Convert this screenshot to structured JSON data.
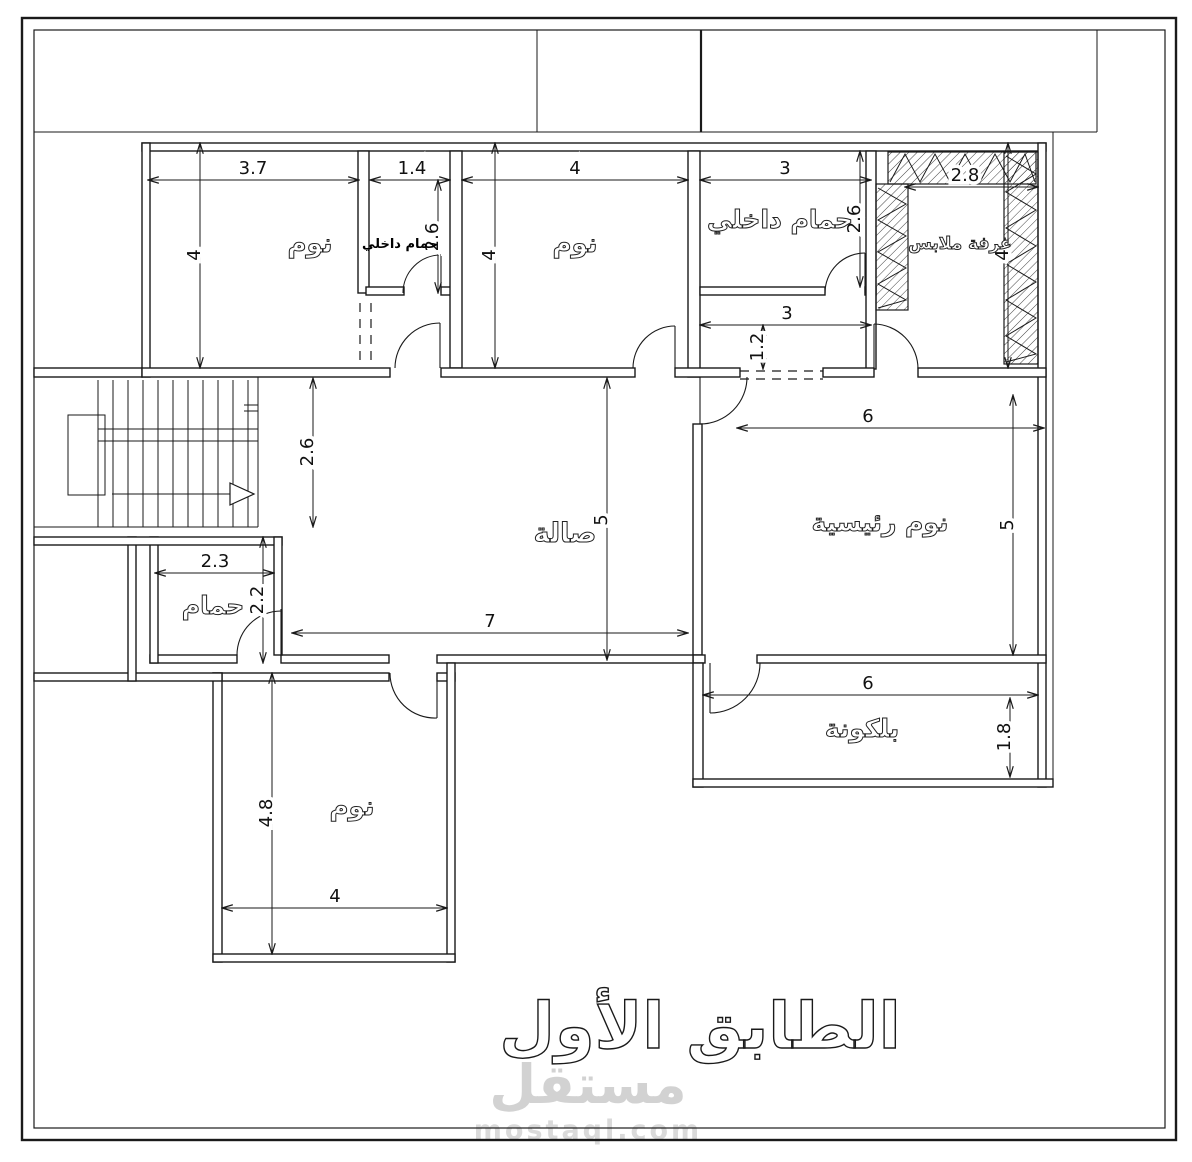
{
  "drawing": {
    "floor_title": "الطابق الأول",
    "watermark": {
      "logo": "مستقل",
      "url": "mostaql.com"
    },
    "colors": {
      "line": "#1a1a1a",
      "watermark_logo": "#d2d2d2",
      "watermark_url": "#dadada"
    },
    "rooms": [
      {
        "id": "bedroom-top-left",
        "label": "نوم",
        "x": 310,
        "y": 252,
        "size": 26,
        "style": "outline"
      },
      {
        "id": "inner-bathroom-small",
        "label": "حمام داخلي",
        "x": 400,
        "y": 248,
        "size": 13,
        "style": "solid"
      },
      {
        "id": "bedroom-top-middle",
        "label": "نوم",
        "x": 575,
        "y": 252,
        "size": 26,
        "style": "outline"
      },
      {
        "id": "inner-bathroom-master",
        "label": "حمام داخلي",
        "x": 780,
        "y": 228,
        "size": 25,
        "style": "outline"
      },
      {
        "id": "dressing-room",
        "label": "غرفة ملابس",
        "x": 960,
        "y": 249,
        "size": 17,
        "style": "outline"
      },
      {
        "id": "hall",
        "label": "صالة",
        "x": 565,
        "y": 542,
        "size": 27,
        "style": "outline"
      },
      {
        "id": "master-bedroom",
        "label": "نوم رئيسية",
        "x": 880,
        "y": 531,
        "size": 25,
        "style": "outline"
      },
      {
        "id": "bathroom",
        "label": "حمام",
        "x": 213,
        "y": 614,
        "size": 25,
        "style": "outline"
      },
      {
        "id": "balcony",
        "label": "بلكونة",
        "x": 862,
        "y": 737,
        "size": 25,
        "style": "outline"
      },
      {
        "id": "bedroom-bottom",
        "label": "نوم",
        "x": 352,
        "y": 815,
        "size": 26,
        "style": "outline"
      }
    ],
    "dimensions": [
      {
        "value": "3.7",
        "orient": "h",
        "x": 253,
        "y": 174
      },
      {
        "value": "1.4",
        "orient": "h",
        "x": 412,
        "y": 174
      },
      {
        "value": "4",
        "orient": "h",
        "x": 575,
        "y": 174
      },
      {
        "value": "3",
        "orient": "h",
        "x": 785,
        "y": 174
      },
      {
        "value": "2.8",
        "orient": "h",
        "x": 965,
        "y": 181
      },
      {
        "value": "4",
        "orient": "v",
        "x": 200,
        "y": 255
      },
      {
        "value": "2.6",
        "orient": "v",
        "x": 438,
        "y": 237
      },
      {
        "value": "4",
        "orient": "v",
        "x": 495,
        "y": 255
      },
      {
        "value": "2.6",
        "orient": "v",
        "x": 860,
        "y": 219
      },
      {
        "value": "4",
        "orient": "v",
        "x": 1008,
        "y": 255
      },
      {
        "value": "3",
        "orient": "h",
        "x": 787,
        "y": 319
      },
      {
        "value": "1.2",
        "orient": "v",
        "x": 763,
        "y": 347
      },
      {
        "value": "6",
        "orient": "h",
        "x": 868,
        "y": 422
      },
      {
        "value": "5",
        "orient": "v",
        "x": 607,
        "y": 520
      },
      {
        "value": "5",
        "orient": "v",
        "x": 1013,
        "y": 525
      },
      {
        "value": "2.6",
        "orient": "v",
        "x": 313,
        "y": 452
      },
      {
        "value": "2.3",
        "orient": "h",
        "x": 215,
        "y": 567
      },
      {
        "value": "2.2",
        "orient": "v",
        "x": 263,
        "y": 600
      },
      {
        "value": "7",
        "orient": "h",
        "x": 490,
        "y": 627
      },
      {
        "value": "6",
        "orient": "h",
        "x": 868,
        "y": 689
      },
      {
        "value": "1.8",
        "orient": "v",
        "x": 1010,
        "y": 737
      },
      {
        "value": "4.8",
        "orient": "v",
        "x": 272,
        "y": 813
      },
      {
        "value": "4",
        "orient": "h",
        "x": 335,
        "y": 902
      }
    ]
  }
}
